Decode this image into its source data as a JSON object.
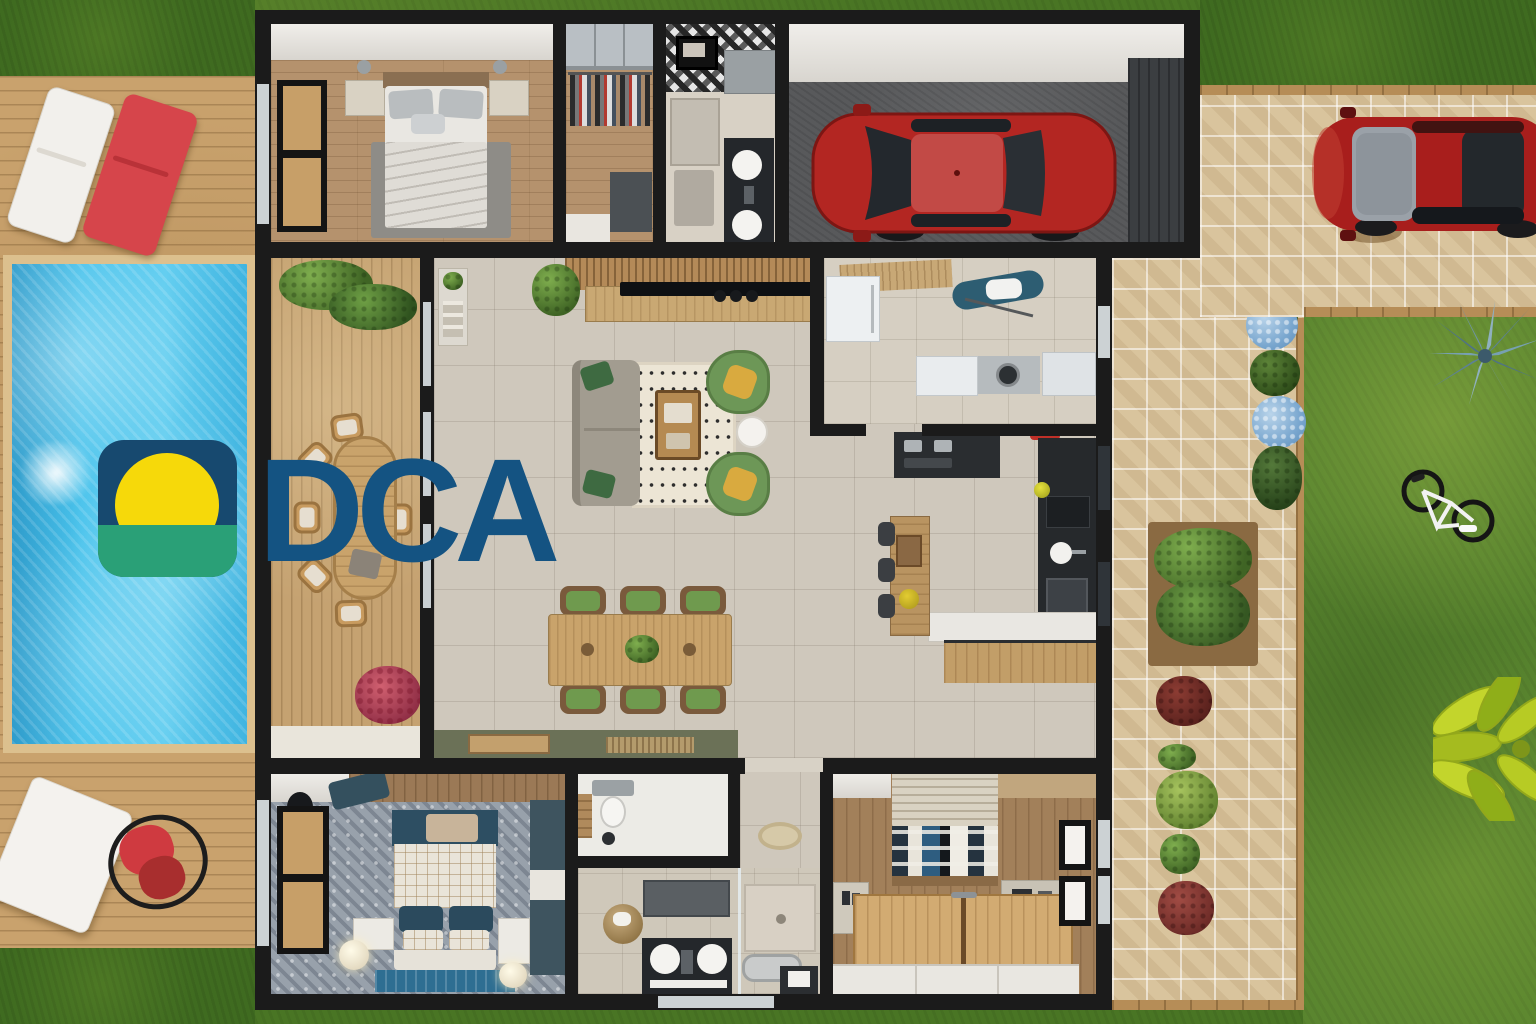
{
  "watermark": {
    "text": "DCA",
    "text_color": "#145382",
    "logo_colors": {
      "sky": "#17496f",
      "sun": "#f6d90a",
      "ground": "#2aa077"
    }
  },
  "scene": {
    "type": "top-down-3d-floor-plan-render",
    "palette": {
      "grass": "#3f6b20",
      "lawn": "#57832e",
      "deck_wood": "#c9a26d",
      "pool_water": "#49c3ec",
      "pavers": "#d9c49d",
      "wall": "#1b1b1b",
      "tile_floor": "#cfc8bc",
      "wood_floor": "#b5926d",
      "car_red": "#b32622",
      "accent_green_chair": "#6d9757",
      "accent_teal": "#2d4e62"
    },
    "outdoor_left": [
      "grass",
      "wood-deck",
      "swimming-pool",
      "pool-jet",
      "sun-lounger-white",
      "sun-lounger-red",
      "daybed",
      "hanging-egg-chair"
    ],
    "outdoor_right": [
      "paver-driveway",
      "parked-red-car",
      "stone-path",
      "planter-box",
      "hydrangeas",
      "shrubs",
      "agave-plant",
      "bicycle",
      "lawn",
      "tropical-plant"
    ],
    "house_rooms": [
      {
        "name": "master-bedroom",
        "contains": [
          "double-bed",
          "nightstands",
          "rug",
          "window"
        ]
      },
      {
        "name": "walk-in-closet",
        "contains": [
          "wardrobe",
          "clothes-rack",
          "dresser"
        ]
      },
      {
        "name": "bathroom-top",
        "contains": [
          "patterned-tile-shower",
          "vanity-sinks",
          "toilet"
        ]
      },
      {
        "name": "garage",
        "contains": [
          "red-car",
          "garage-door"
        ]
      },
      {
        "name": "terrace",
        "contains": [
          "oval-dining-table",
          "wicker-chairs",
          "planters",
          "flowers"
        ]
      },
      {
        "name": "living-room",
        "contains": [
          "tv-console",
          "sofa",
          "rug",
          "coffee-table",
          "armchairs",
          "side-table",
          "plants"
        ]
      },
      {
        "name": "dining-area",
        "contains": [
          "wood-table",
          "six-chairs",
          "sideboard"
        ]
      },
      {
        "name": "laundry-room",
        "contains": [
          "fridge",
          "ironing-board",
          "washer",
          "counters"
        ]
      },
      {
        "name": "kitchen",
        "contains": [
          "cooktop",
          "hood",
          "sink",
          "oven",
          "breakfast-bar",
          "stools",
          "stand-mixer"
        ]
      },
      {
        "name": "bedroom-blue",
        "contains": [
          "bed-teal-headboard",
          "lamps",
          "wardrobe",
          "window"
        ]
      },
      {
        "name": "toilet-room",
        "contains": [
          "toilet"
        ]
      },
      {
        "name": "hallway",
        "contains": [
          "round-rug"
        ]
      },
      {
        "name": "bathroom-bottom",
        "contains": [
          "mirror",
          "basket",
          "double-sink",
          "shower",
          "bathtub"
        ]
      },
      {
        "name": "bedroom-wood",
        "contains": [
          "bed-checkered-blanket",
          "wood-platform",
          "wardrobe",
          "windows"
        ]
      }
    ]
  }
}
